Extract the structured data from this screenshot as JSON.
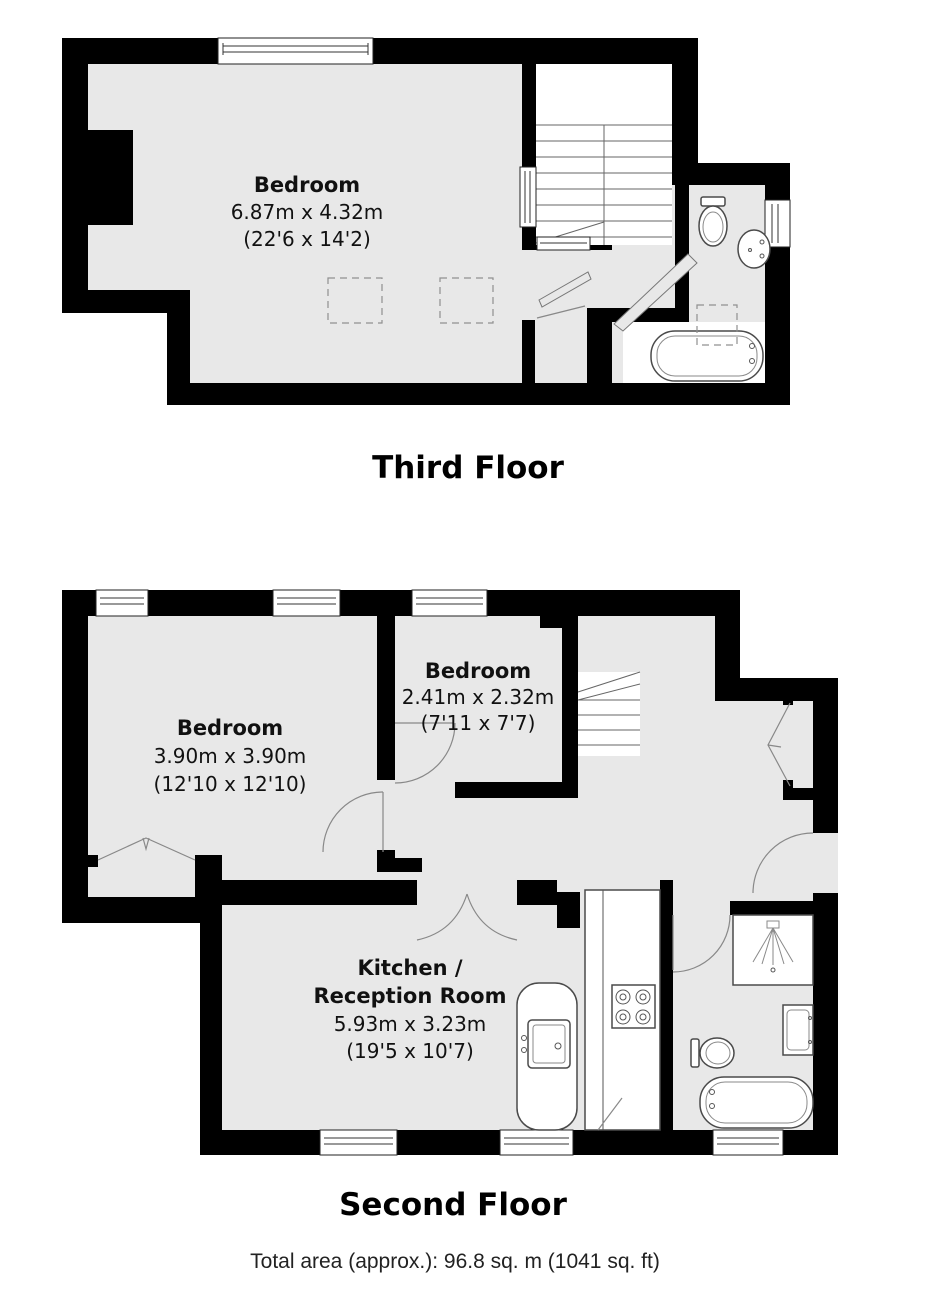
{
  "colors": {
    "wall": "#000000",
    "floor": "#e8e8e8",
    "page": "#ffffff"
  },
  "floors": [
    {
      "title": "Third Floor",
      "rooms": [
        {
          "name": "Bedroom",
          "metric": "6.87m x 4.32m",
          "imperial": "(22'6 x 14'2)"
        }
      ]
    },
    {
      "title": "Second Floor",
      "rooms": [
        {
          "name": "Bedroom",
          "metric": "3.90m x 3.90m",
          "imperial": "(12'10 x 12'10)"
        },
        {
          "name": "Bedroom",
          "metric": "2.41m x 2.32m",
          "imperial": "(7'11 x 7'7)"
        },
        {
          "name": "Kitchen /",
          "name_line2": "Reception Room",
          "metric": "5.93m x 3.23m",
          "imperial": "(19'5 x 10'7)"
        }
      ]
    }
  ],
  "footer": {
    "total_area": "Total area (approx.): 96.8 sq. m (1041 sq. ft)"
  }
}
